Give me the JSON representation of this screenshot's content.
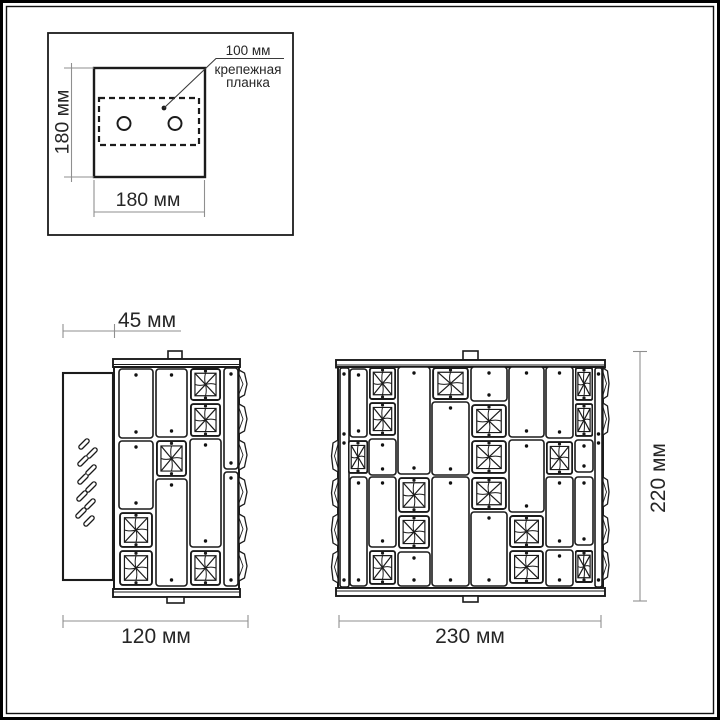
{
  "colors": {
    "line": "#1b1b1b",
    "dim_line": "#8f8f8f",
    "text": "#262626",
    "background": "#ffffff"
  },
  "mounting_inset": {
    "hole_pitch": "100 мм",
    "bracket_label_line1": "крепежная",
    "bracket_label_line2": "планка",
    "height": "180 мм",
    "width": "180 мм"
  },
  "side_view": {
    "depth": "45 мм",
    "width": "120 мм"
  },
  "front_view": {
    "width": "230 мм",
    "height": "220 мм"
  }
}
